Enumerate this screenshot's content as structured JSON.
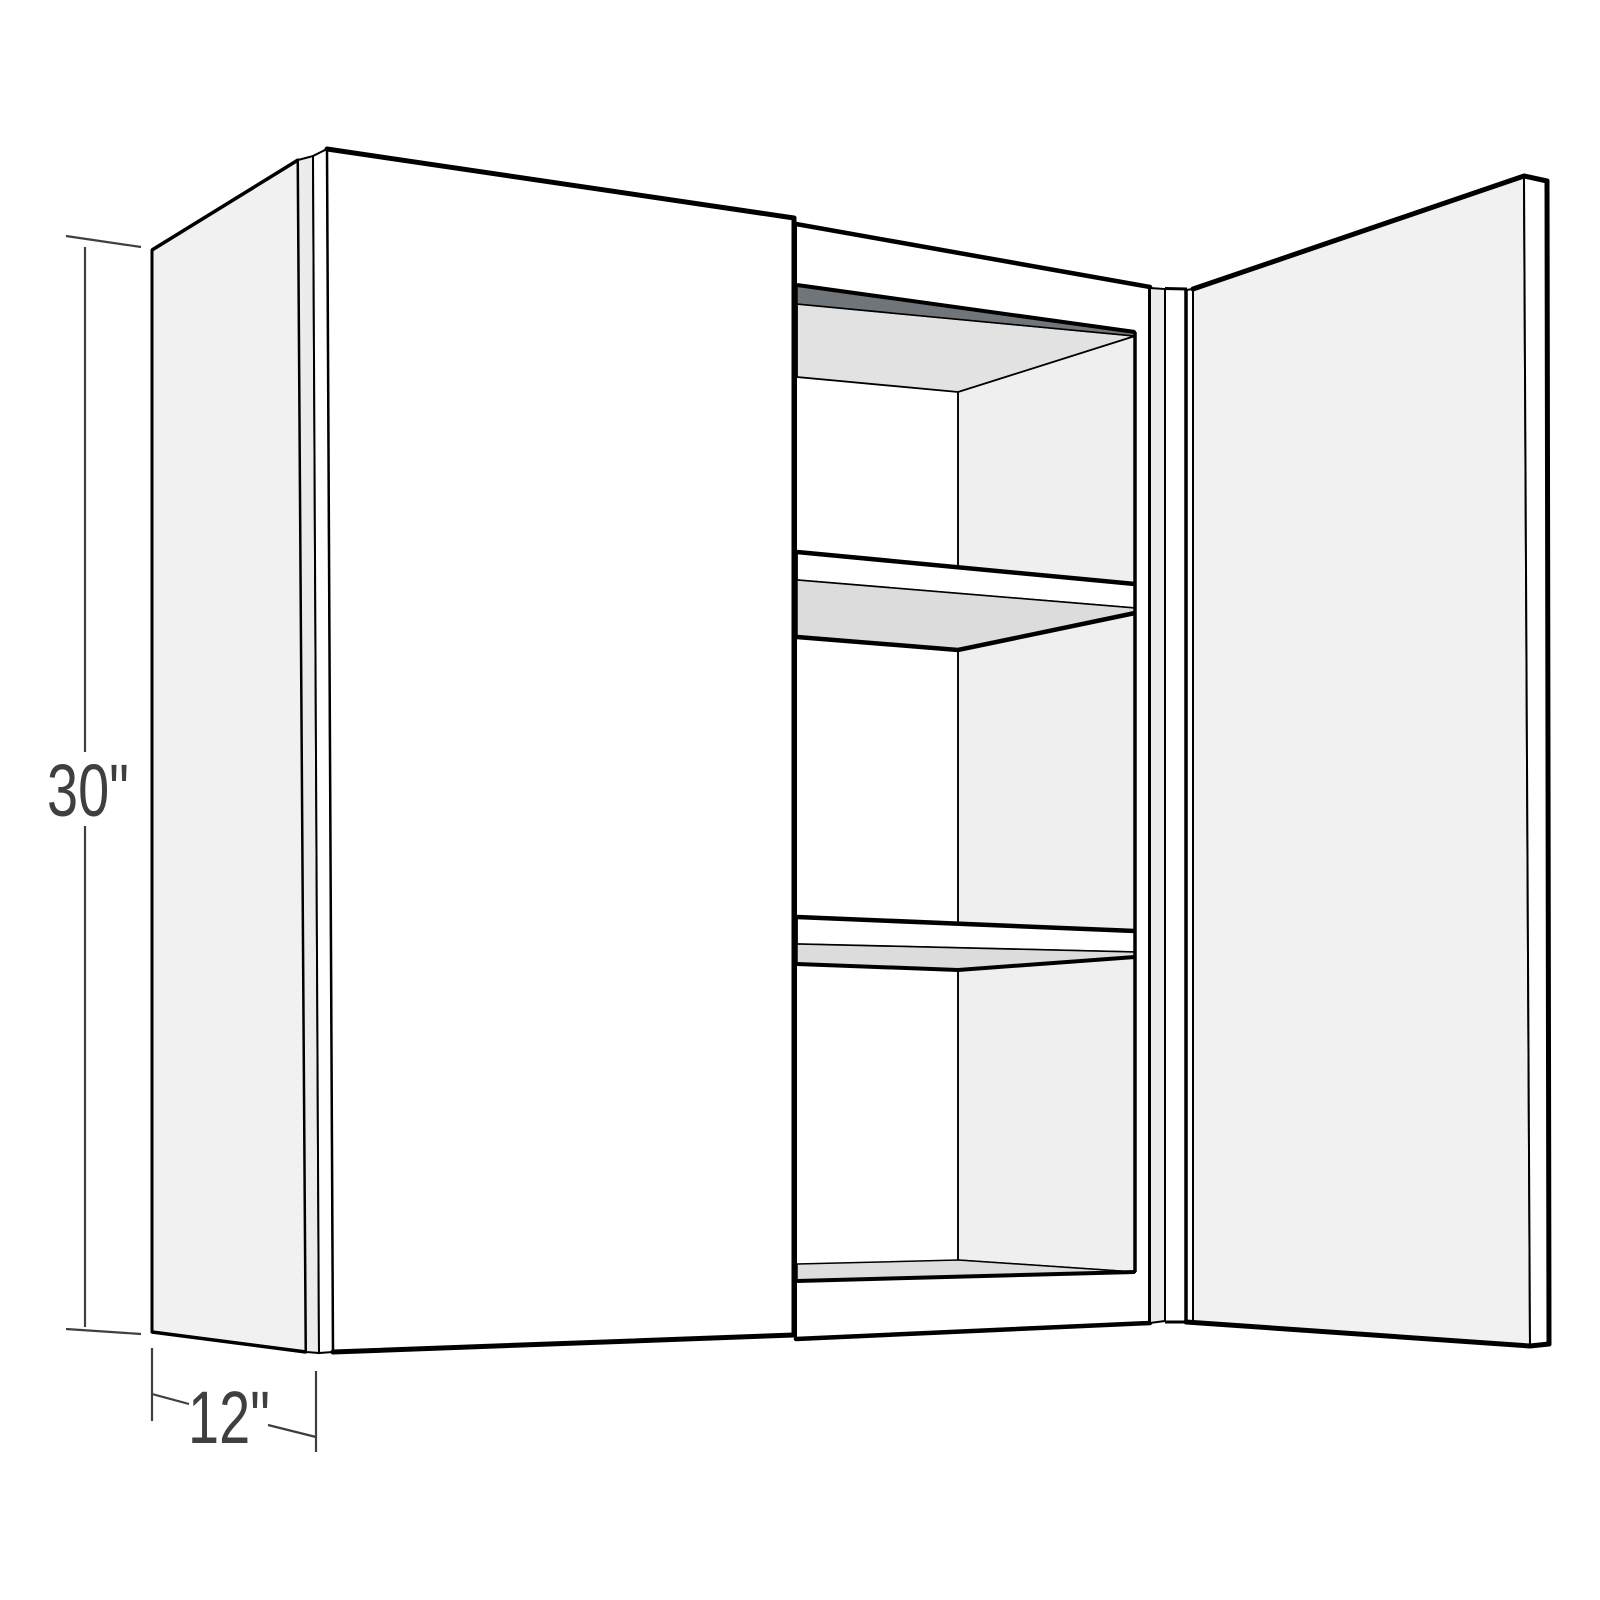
{
  "figure": {
    "type": "3d-perspective-line-drawing",
    "subject": "Two-door wall cabinet shown in three-quarter perspective; left door closed, right door open revealing an interior with two adjustable shelves, top, bottom and back panels",
    "shelf_count": 2
  },
  "dimensions": {
    "height": {
      "label": "30\""
    },
    "depth": {
      "label": "12\""
    }
  },
  "colors": {
    "background": "#ffffff",
    "outline": "#000000",
    "front_white": "#ffffff",
    "side_panel": "#f1f1f1",
    "panel_edge": "#ececec",
    "open_door_face": "#f1f1f1",
    "interior_right_wall": "#efefef",
    "interior_back_wall": "#ffffff",
    "ceiling_underside": "#e2e2e2",
    "floor_top": "#dedede",
    "shelf_underside": "#dcdcdc",
    "top_rail_shadow": "#70757a",
    "dimension": "#3f3f3f"
  }
}
